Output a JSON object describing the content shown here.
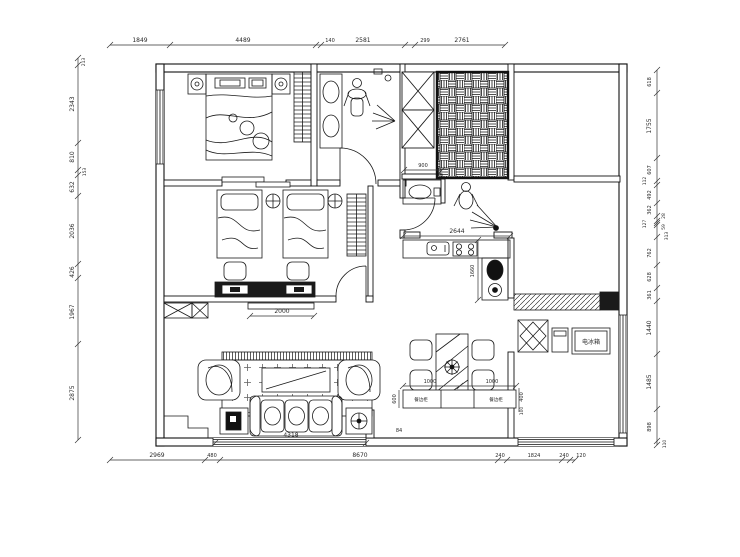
{
  "drawing": {
    "type": "apartment-floor-plan"
  },
  "dims": {
    "top": [
      "1849",
      "4489",
      "140",
      "2581",
      "299",
      "2761"
    ],
    "left": [
      "213",
      "2343",
      "810",
      "153",
      "632",
      "2036",
      "426",
      "1967",
      "2875"
    ],
    "right": [
      "618",
      "1755",
      "607",
      "112",
      "492",
      "362",
      "127",
      "28",
      "59",
      "313",
      "762",
      "628",
      "361",
      "1440",
      "1485",
      "898",
      "110"
    ],
    "bottom": [
      "2969",
      "480",
      "8670",
      "240",
      "1824",
      "240",
      "120"
    ],
    "inner": {
      "tv_bench": "2000",
      "living_window": "4318",
      "entry": "84",
      "basin": "900",
      "kitchen_counter": "2644",
      "kitchen_side": "1660",
      "sideboard_left": "1000",
      "sideboard_right": "1000",
      "sideboard_depth": "600",
      "balcony_a": "400",
      "balcony_b": "100"
    }
  },
  "labels": {
    "fridge": "电冰箱",
    "sideboard": "餐边柜"
  },
  "colors": {
    "line": "#1a1a1a",
    "background": "#ffffff"
  }
}
